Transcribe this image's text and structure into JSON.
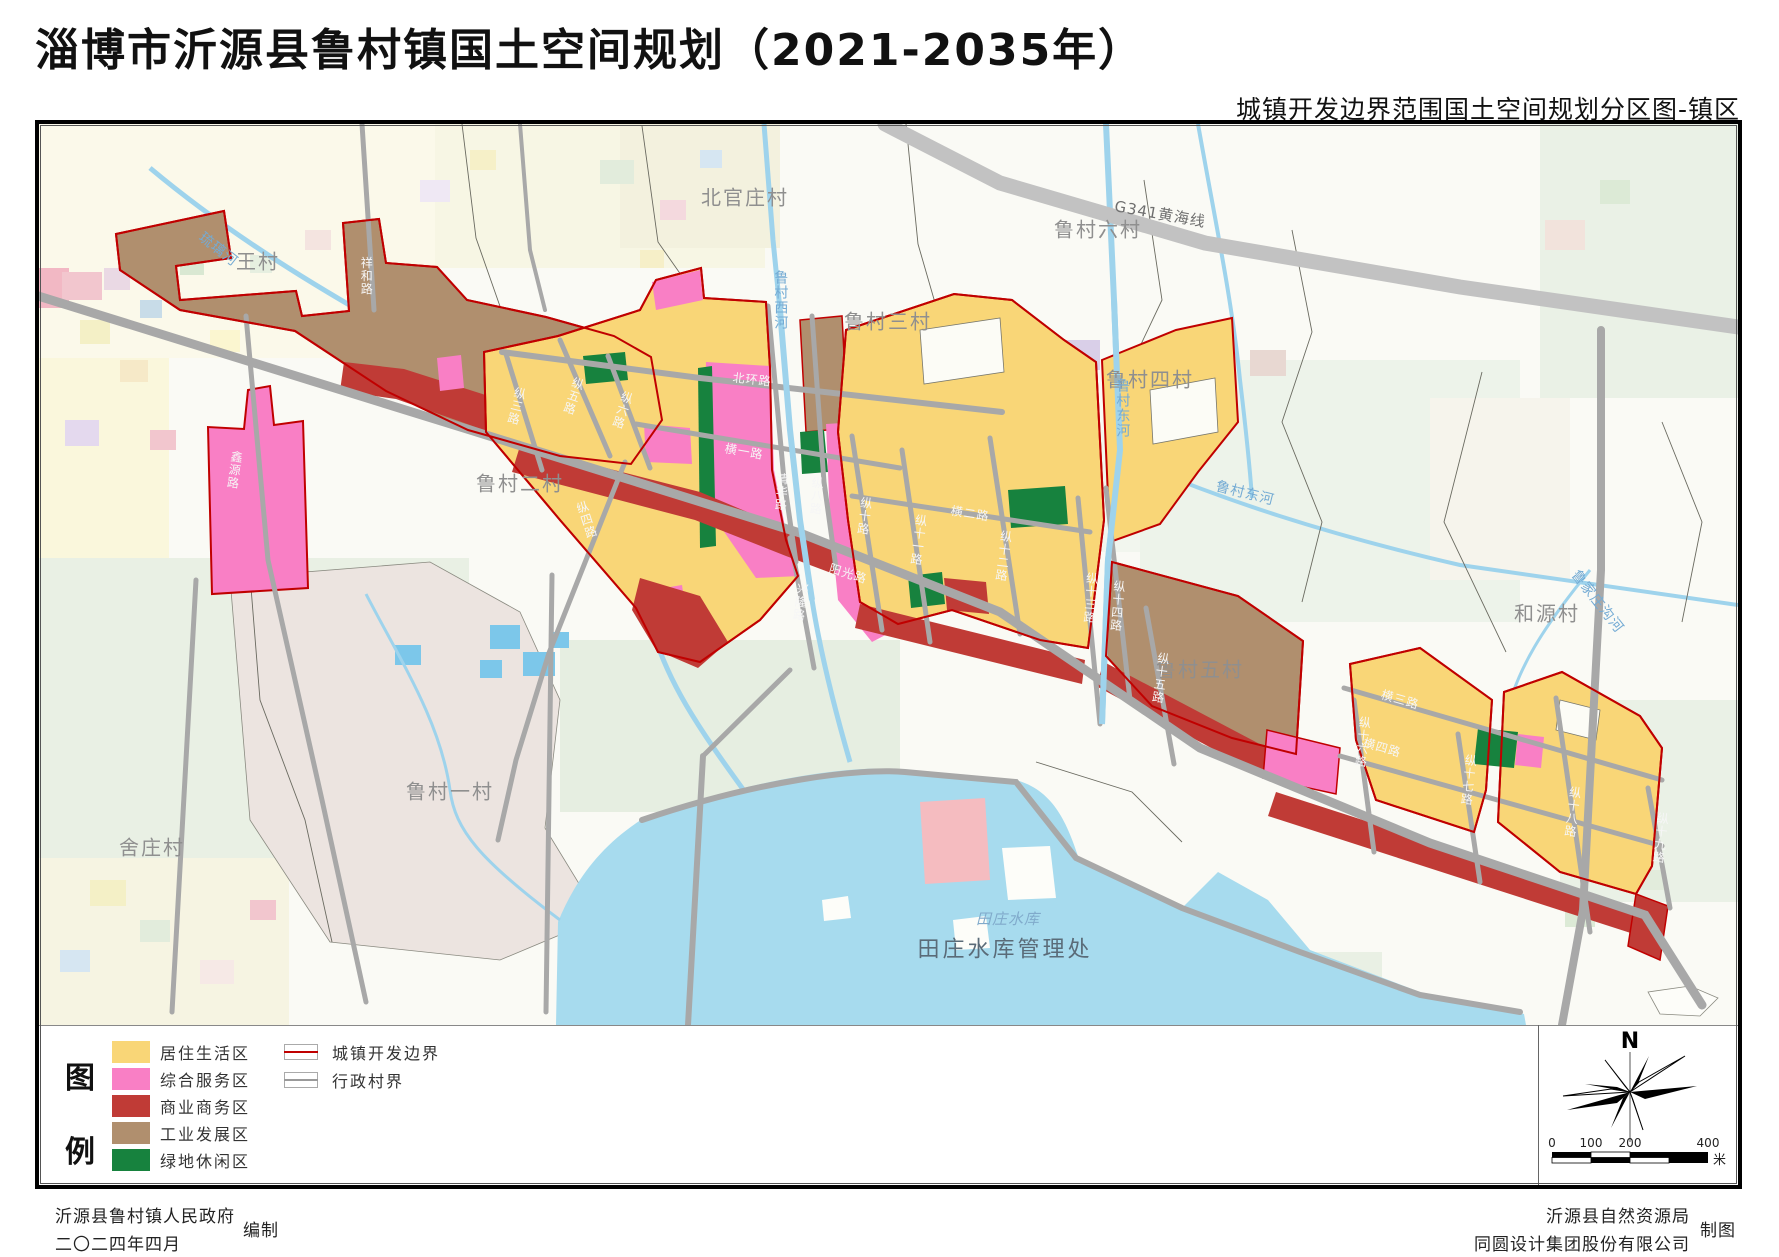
{
  "page": {
    "title": "淄博市沂源县鲁村镇国土空间规划（2021-2035年）",
    "subtitle": "城镇开发边界范围国土空间规划分区图-镇区"
  },
  "legend": {
    "label_top": "图",
    "label_bottom": "例",
    "zones": [
      {
        "label": "居住生活区",
        "color": "#F9D677"
      },
      {
        "label": "综合服务区",
        "color": "#F97FC5"
      },
      {
        "label": "商业商务区",
        "color": "#C03B36"
      },
      {
        "label": "工业发展区",
        "color": "#B08F6E"
      },
      {
        "label": "绿地休闲区",
        "color": "#17823E"
      }
    ],
    "lines": [
      {
        "label": "城镇开发边界",
        "color": "#C00000"
      },
      {
        "label": "行政村界",
        "color": "#9A9A9A"
      }
    ]
  },
  "map": {
    "villages": [
      "王村",
      "北官庄村",
      "鲁村三村",
      "鲁村六村",
      "鲁村四村",
      "鲁村二村",
      "和源村",
      "鲁村五村",
      "鲁村一村",
      "舍庄村"
    ],
    "rivers": [
      "琉璃河",
      "鲁村西河",
      "鲁村东河",
      "鲁村东河",
      "鲁家庄沟河"
    ],
    "roads": [
      "阳光路",
      "北环路",
      "横一路",
      "横二路",
      "横三路",
      "横四路",
      "纵三路",
      "纵四路",
      "纵五路",
      "纵六路",
      "清华路",
      "纵八路",
      "兴隆路",
      "纵十路",
      "纵十一路",
      "纵十二路",
      "纵十三路",
      "纵十四路",
      "纵十五路",
      "纵十六路",
      "纵十七路",
      "纵十八路",
      "纵十九路",
      "祥和路",
      "鑫源路",
      "G341黄海线"
    ],
    "waters": [
      "田庄水库",
      "田庄水库管理处"
    ]
  },
  "north": {
    "label": "N"
  },
  "scalebar": {
    "ticks": [
      "0",
      "100",
      "200",
      "400"
    ],
    "unit": "米"
  },
  "footer": {
    "left_org": "沂源县鲁村镇人民政府",
    "left_date": "二〇二四年四月",
    "left_role": "编制",
    "right_org_1": "沂源县自然资源局",
    "right_org_2": "同圆设计集团股份有限公司",
    "right_role": "制图"
  }
}
